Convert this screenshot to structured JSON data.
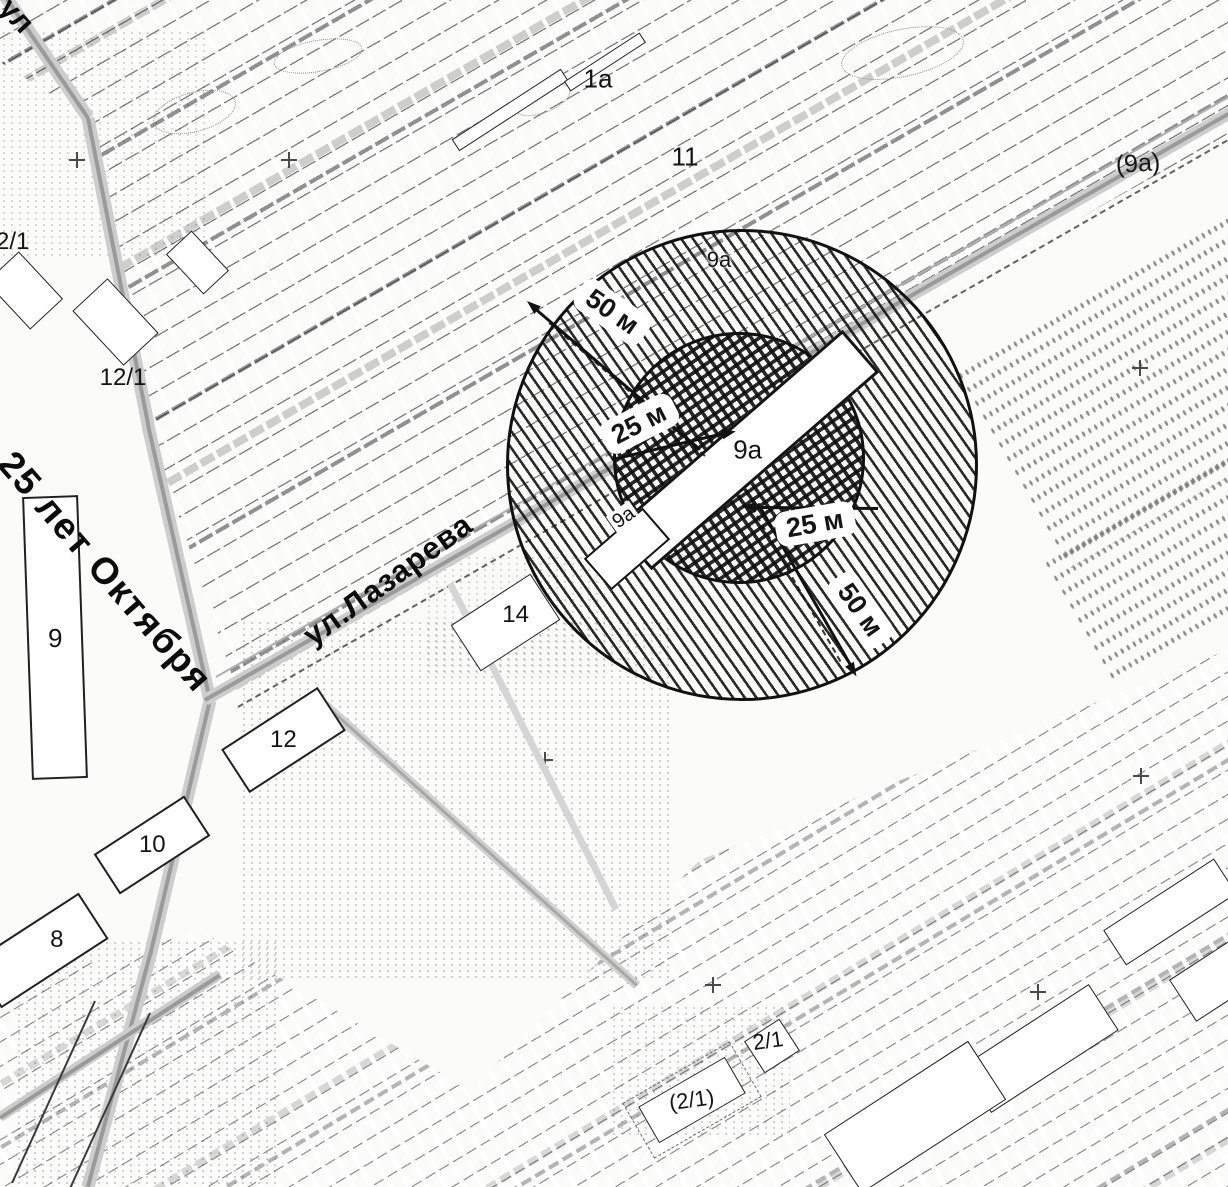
{
  "colors": {
    "ink": "#1a1a1a",
    "road_gray": "#9a9a9a",
    "road_light": "#cccccc",
    "paper": "#fbfbf9"
  },
  "streets": {
    "oktyabrya": {
      "label": "25 лет Октября"
    },
    "lazareva": {
      "label": "ул.Лазарева"
    },
    "corner": {
      "label": "ул"
    }
  },
  "labels": {
    "area_11": "11",
    "area_1a": "1а",
    "area_9a_paren": "(9а)"
  },
  "buildings": {
    "b9": "9",
    "b12": "12",
    "b10": "10",
    "b8": "8",
    "b14": "14",
    "b12_1_left": "12/1",
    "b12_1_mid": "12/1",
    "b2_1": "2/1",
    "b2_1_paren": "(2/1)"
  },
  "zone": {
    "radius_outer_top": "50 м",
    "radius_outer_bottom": "50 м",
    "radius_inner_top": "25 м",
    "radius_inner_bottom": "25 м",
    "building": "9а",
    "building_small": "9а",
    "area_top": "9а"
  }
}
